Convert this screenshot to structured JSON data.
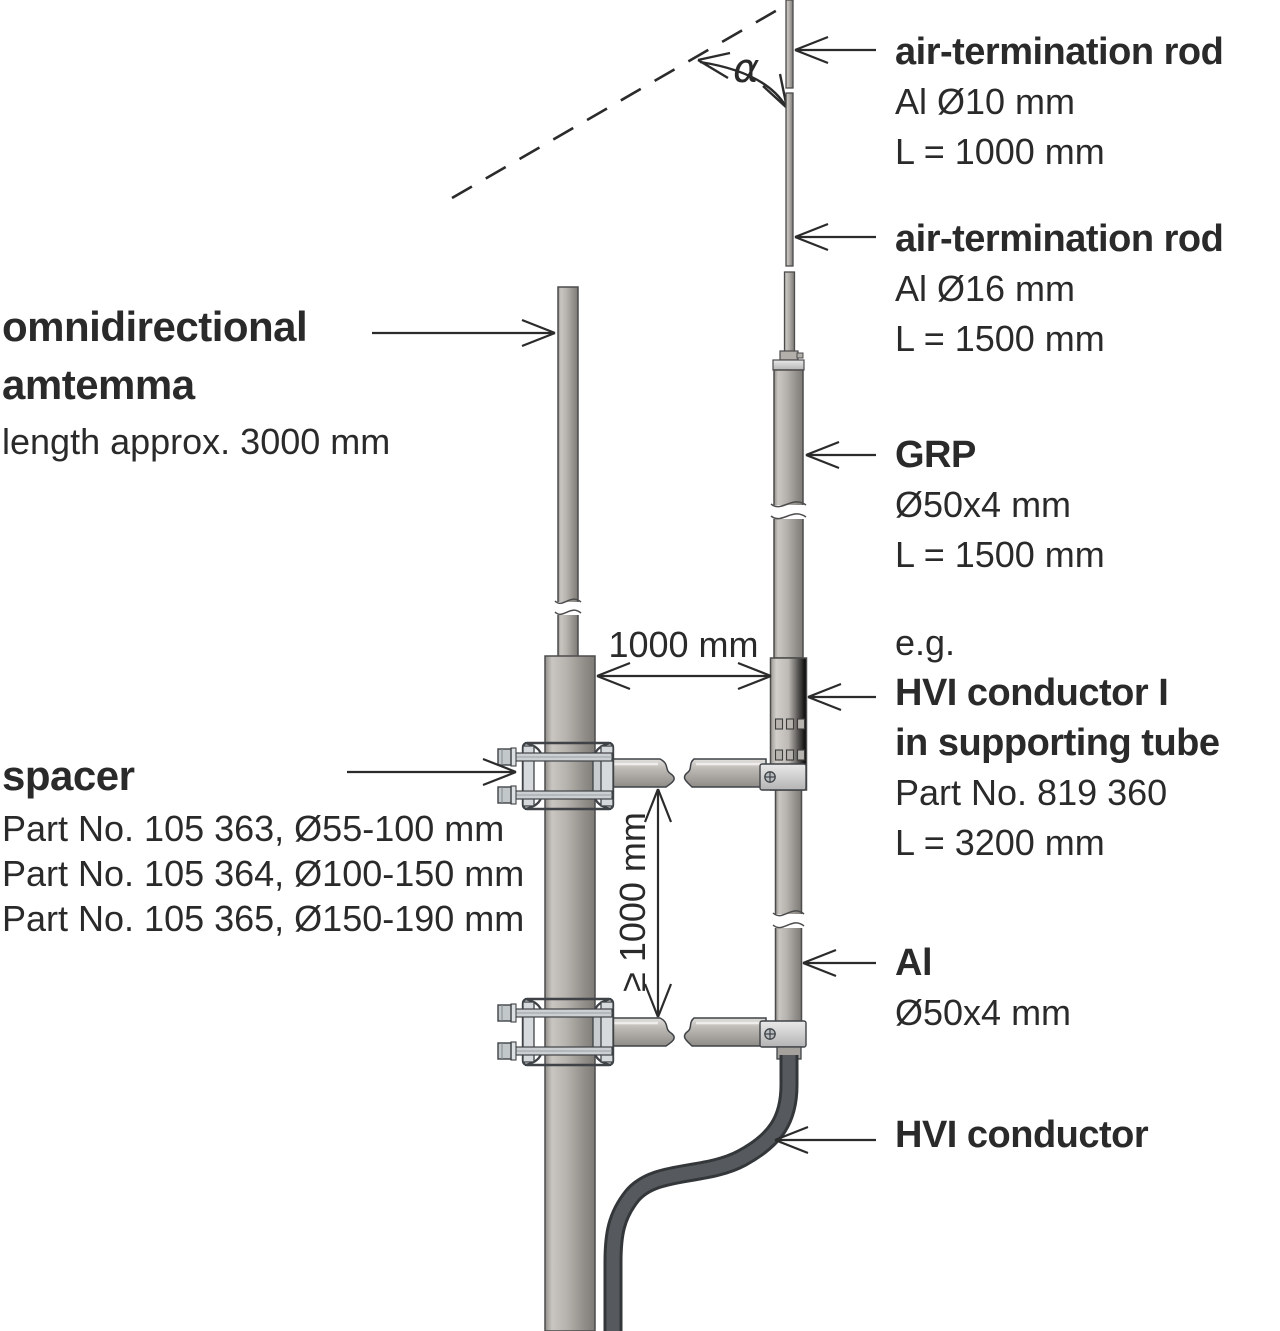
{
  "labels": {
    "rod_upper": {
      "title": "air-termination rod",
      "spec": "Al Ø10 mm",
      "length": "L = 1000 mm"
    },
    "rod_lower": {
      "title": "air-termination rod",
      "spec": "Al Ø16 mm",
      "length": "L = 1500 mm"
    },
    "grp": {
      "title": "GRP",
      "spec": "Ø50x4 mm",
      "length": "L = 1500 mm"
    },
    "hvi_supporting": {
      "prefix": "e.g.",
      "title_line1": "HVI conductor I",
      "title_line2": "in supporting tube",
      "part": "Part No. 819 360",
      "length": "L = 3200 mm"
    },
    "al_tube": {
      "title": "Al",
      "spec": "Ø50x4 mm"
    },
    "hvi_conductor": {
      "title": "HVI conductor"
    },
    "antenna": {
      "title_line1": "omnidirectional",
      "title_line2": "amtemma",
      "length": "length approx. 3000 mm"
    },
    "spacer": {
      "title": "spacer",
      "part1": "Part No. 105 363, Ø55-100 mm",
      "part2": "Part No. 105 364, Ø100-150 mm",
      "part3": "Part No. 105 365, Ø150-190 mm"
    }
  },
  "dimensions": {
    "horizontal_spacing": "1000 mm",
    "vertical_spacing": "≥ 1000 mm",
    "protection_angle": "α"
  },
  "colors": {
    "text": "#2a2a2a",
    "line": "#2b2b2b",
    "metal_light": "#c6c3bf",
    "metal_dark": "#7e7a75",
    "steel_fitting": "#d7dadc",
    "cable": "#56595d",
    "background": "#ffffff"
  }
}
